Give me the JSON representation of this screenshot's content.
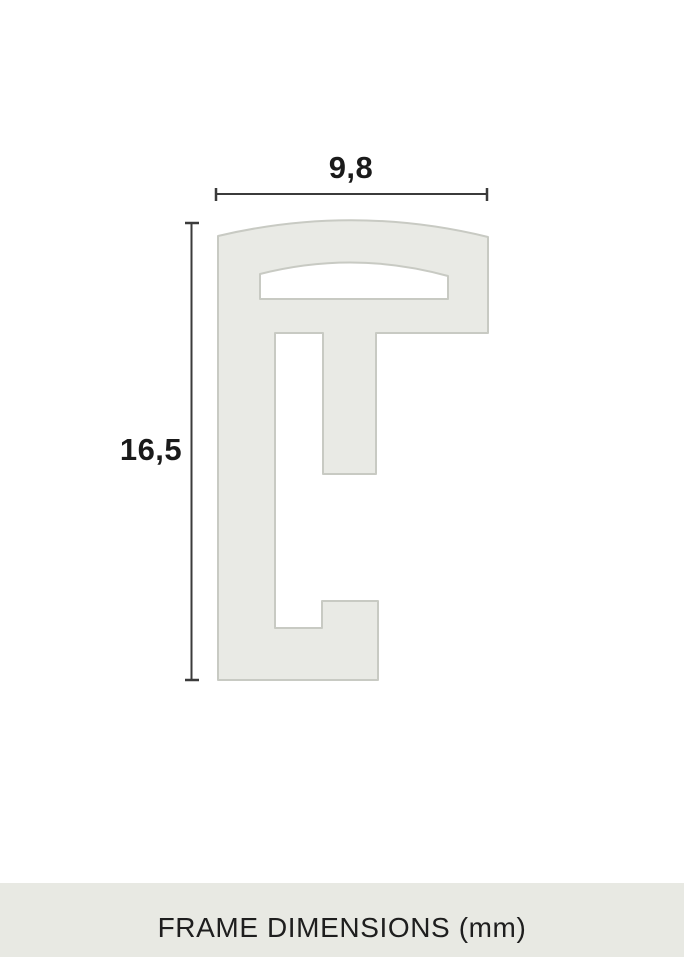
{
  "diagram": {
    "title": "frame profile cross-section with dimensions",
    "unit": "mm",
    "width_label": "9,8",
    "height_label": "16,5",
    "width_mm": 9.8,
    "height_mm": 16.5,
    "caption": "FRAME DIMENSIONS (mm)",
    "colors": {
      "background": "#FFFFFF",
      "profile_fill": "#E9EAE5",
      "profile_stroke": "#C8CAC3",
      "dimension_line": "#3B3B3B",
      "label_text": "#1A1A1A",
      "caption_band_bg": "#E8E9E3",
      "caption_text": "#1E1E1E"
    }
  }
}
